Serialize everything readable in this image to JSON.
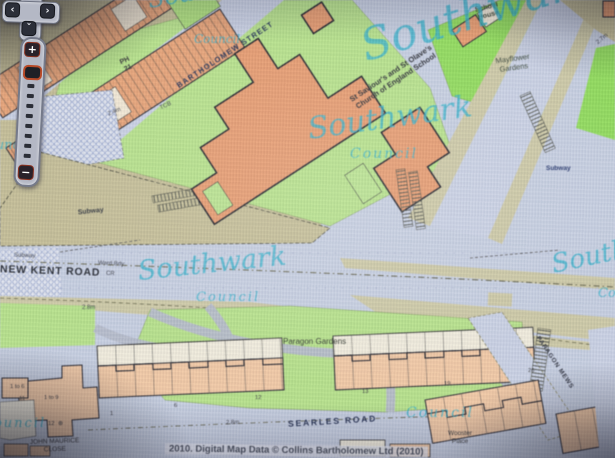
{
  "controls": {
    "pan_up": "ˆ",
    "pan_left": "‹",
    "pan_right": "›",
    "pan_down": "ˇ",
    "zoom_in": "+",
    "zoom_out": "−"
  },
  "watermark": {
    "script": "Southwark",
    "sub": "Council"
  },
  "streets": {
    "bartholomew": "BARTHOLOMEW STREET",
    "new_kent": "NEW KENT ROAD",
    "searles": "SEARLES ROAD",
    "john_maurice_1": "JOHN MAURICE",
    "john_maurice_2": "CLOSE",
    "paragon_mews": "PARAGON MEWS"
  },
  "places": {
    "school_1": "St Saviour's and St Olave's",
    "school_2": "Church of England School",
    "school_house_1": "School",
    "school_house_2": "House",
    "mayflower_1": "Mayflower",
    "mayflower_2": "Gardens",
    "paragon_gardens": "Paragon Gardens",
    "wooster_1": "Wooster",
    "wooster_2": "Place"
  },
  "features": {
    "subway": "Subway",
    "ward_bdy": "Ward Bdy",
    "cr": "CR",
    "ph": "PH",
    "ph_number": "21",
    "tcb": "TCB",
    "depth_24": "2.4m",
    "depth_27": "2.7m",
    "depth_28": "2.8m",
    "access_symbol": "⊕"
  },
  "house_numbers": {
    "n1to6": "1 to 6",
    "n11": "11",
    "n1to9": "1 to 9",
    "n12a": "12",
    "n1": "1",
    "n6": "6",
    "n12b": "12",
    "n13": "13",
    "n19": "19",
    "n26": "26"
  },
  "copyright": "2010. Digital Map Data © Collins Bartholomew Ltd (2010)",
  "colors": {
    "watermark": "#2fb0c9",
    "building_strong": "#e8996a",
    "building_light": "#f3c8a2",
    "green": "#b5e286",
    "green_bright": "#8edc55",
    "road": "#c6cee1",
    "ground": "#c4bd93"
  }
}
